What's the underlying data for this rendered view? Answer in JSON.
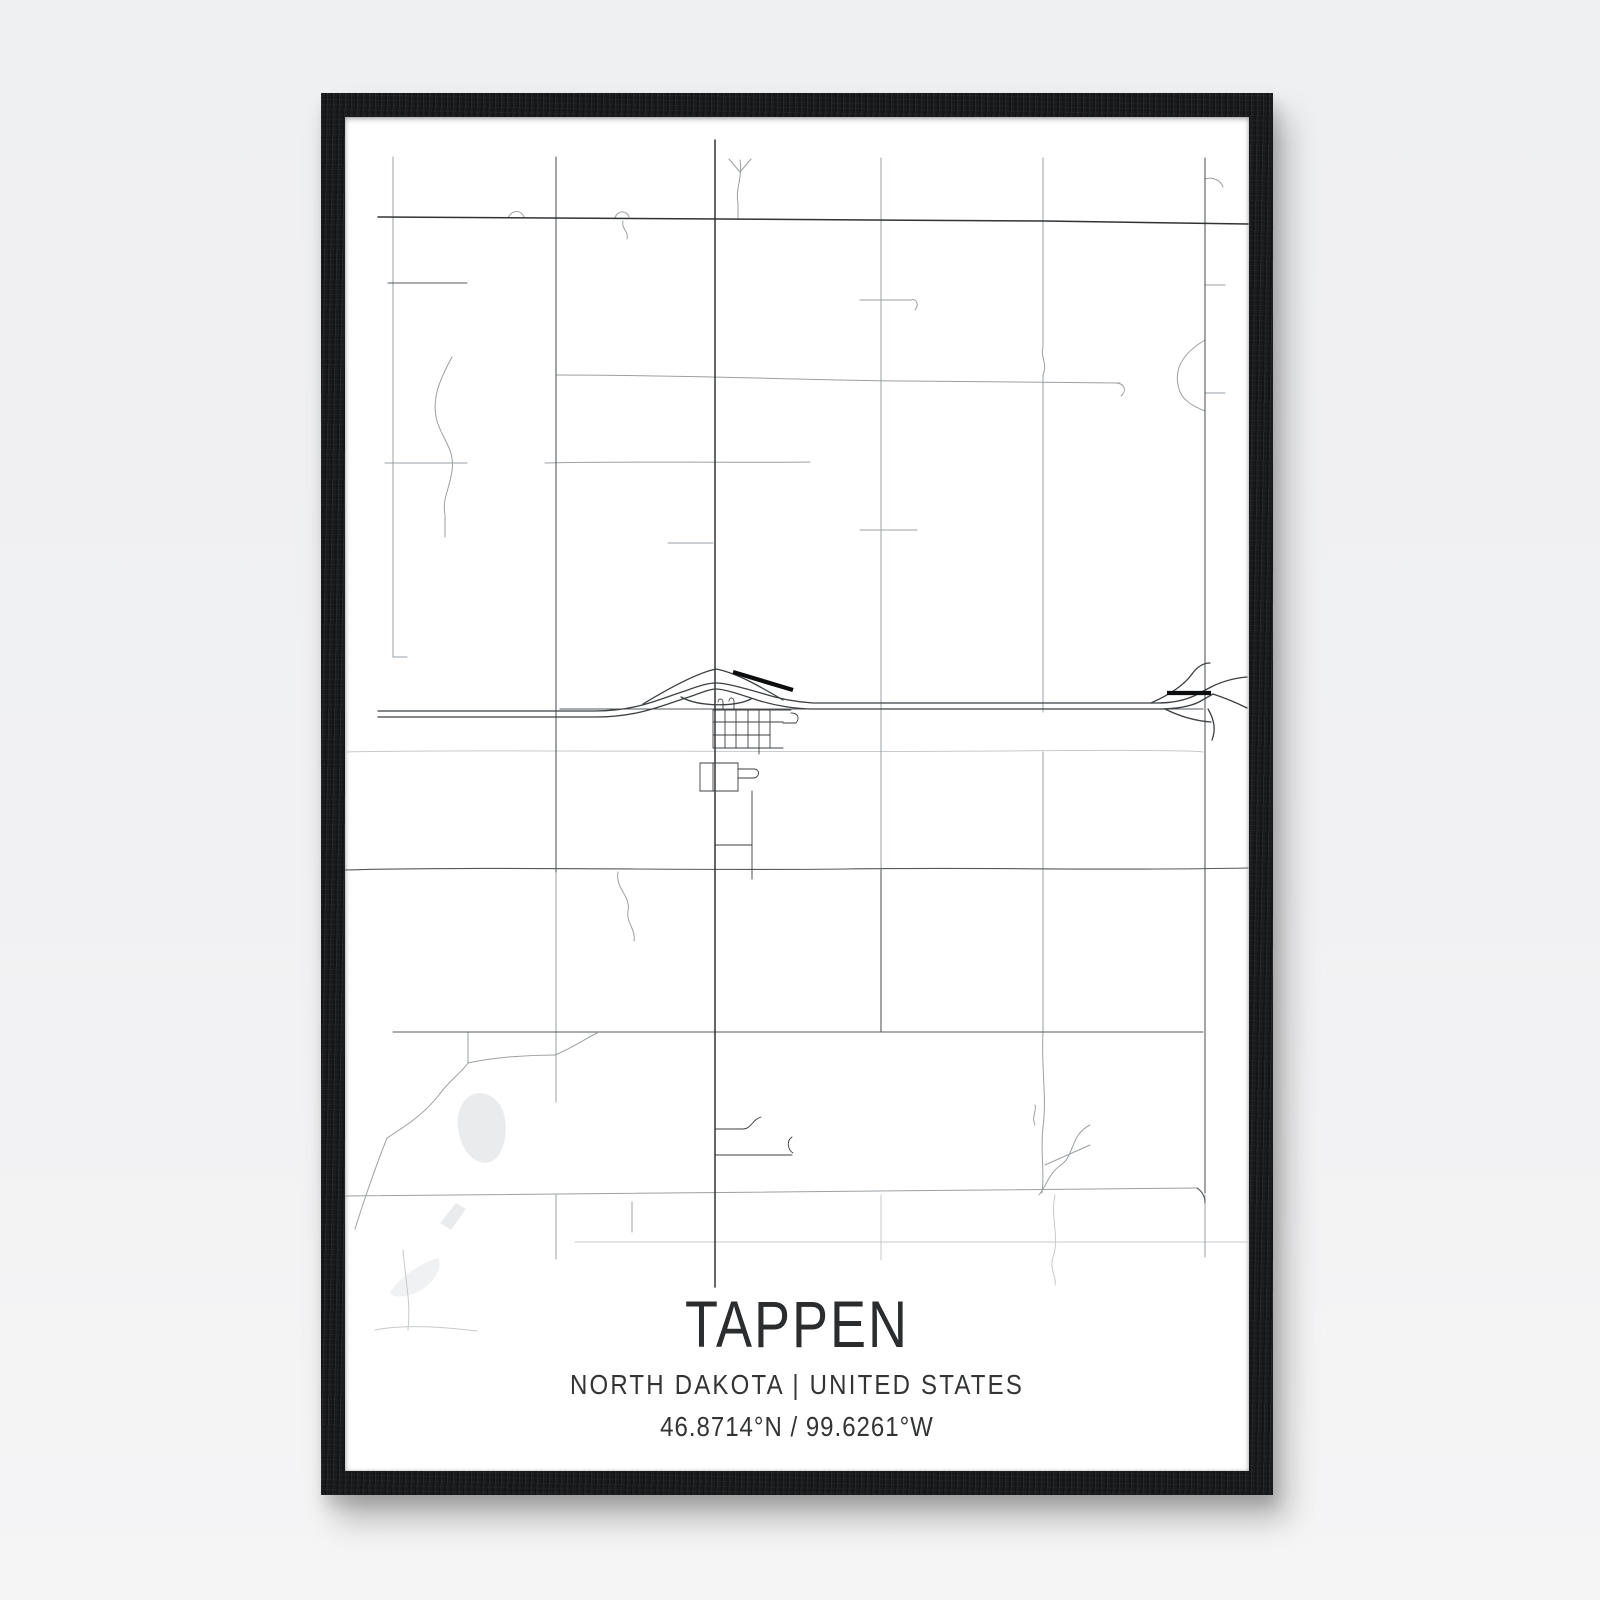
{
  "page": {
    "background_color": "#f1f1f3"
  },
  "frame": {
    "color": "#191a1c",
    "material": "black-wood"
  },
  "poster": {
    "background_color": "#ffffff",
    "title": "TAPPEN",
    "subtitle": "NORTH DAKOTA | UNITED STATES",
    "coordinates": "46.8714°N / 99.6261°W",
    "text_color": "#2a2c2e"
  },
  "map": {
    "type": "street-map",
    "location": {
      "city": "Tappen",
      "state": "North Dakota",
      "country": "United States",
      "latitude_label": "46.8714°N",
      "longitude_label": "99.6261°W"
    },
    "viewBox": "0 0 904 1354",
    "water": [
      {
        "name": "lake",
        "color": "#e9ebed",
        "paths": [
          "M118,986 C128,970 150,974 158,994 C164,1012 160,1034 149,1043 C137,1051 121,1041 115,1021 C111,1006 112,996 118,986 Z",
          "M95,1106 L111,1086 L121,1092 L106,1113 Z"
        ]
      },
      {
        "name": "pond-faint",
        "color": "#f0f1f2",
        "paths": [
          "M45,1176 C54,1160 76,1146 93,1141 C98,1150 90,1166 74,1174 C61,1181 49,1181 45,1176 Z"
        ]
      }
    ],
    "layers": [
      {
        "name": "faint",
        "color": "#c6cacd",
        "width": 1,
        "paths": [
          "M0,635 C150,632 400,636 650,634 S850,636 858,635",
          "M230,1125 H903",
          "M30,1213 C60,1207 100,1210 132,1214",
          "M58,1133 C60,1160 66,1185 63,1213",
          "M710,1078 C705,1100 715,1120 708,1140 C704,1152 712,1160 710,1168",
          "M536,1078 V1143"
        ]
      },
      {
        "name": "minor",
        "color": "#9ba0a4",
        "width": 1,
        "paths": [
          "M48,40 V540",
          "M48,540 H62",
          "M211,755 V985",
          "M211,1078 V1142",
          "M536,41 V753",
          "M698,41 V230 C695,240 703,246 698,258 V595",
          "M698,635 V915",
          "M698,915 C696,950 702,980 698,1010 C695,1035 700,1055 697,1076",
          "M860,1078 V1140",
          "M211,258 C350,258 450,263 560,264 L775,266",
          "M770,266 C780,266 782,274 776,279",
          "M40,346 H122",
          "M200,346 C280,344 380,346 465,345",
          "M515,413 H572",
          "M323,426 H368",
          "M860,62 C868,59 876,64 878,70",
          "M860,168 H880",
          "M860,276 H880",
          "M515,183 H566 C572,181 574,188 570,193",
          "M395,43 C398,60 390,72 393,86 V101",
          "M395,55 L384,42",
          "M395,55 L406,42",
          "M107,240 C95,262 86,282 92,304 C98,324 110,332 107,354 C104,374 97,382 100,398 V420",
          "M273,755 C270,772 286,778 283,794 C281,806 291,812 289,824",
          "M860,223 C838,236 828,252 834,272 C837,284 850,290 860,294",
          "M745,1008 C725,1018 730,1038 716,1048 C704,1056 702,1068 694,1078",
          "M700,1048 L745,1028",
          "M690,1008 C686,1000 692,994 690,988",
          "M42,1021 C62,1008 78,998 94,978 C102,966 116,956 123,946",
          "M10,1112 C18,1086 32,1046 42,1021",
          "M123,915 V946",
          "M123,946 C150,940 185,938 210,938",
          "M210,938 C225,932 240,922 252,916",
          "M287,1085 V1115",
          "M0,1079 L852,1071",
          "M163,101 C166,93 176,92 179,100",
          "M270,101 C272,93 282,93 284,100",
          "M278,104 C276,112 284,114 282,122"
        ]
      },
      {
        "name": "medium",
        "color": "#55595d",
        "width": 1.1,
        "paths": [
          "M43,166 H122",
          "M211,40 V755",
          "M536,753 V915",
          "M215,592 H858",
          "M0,753 C150,749 350,754 500,752 S750,754 903,751",
          "M48,915 H858",
          "M860,41 V1076",
          "M852,1071 C858,1075 860,1080 860,1086"
        ]
      },
      {
        "name": "major",
        "color": "#303336",
        "width": 1.5,
        "paths": [
          "M33,100 L700,104 L903,107",
          "M370,23 V1170"
        ]
      },
      {
        "name": "highway",
        "color": "#3c4043",
        "width": 1.3,
        "paths": [
          "M33,594 H250 C292,594 314,582 340,574 C356,568 364,566 371,566 C381,566 398,571 416,576 C434,582 452,585 468,586 H812 C830,586 843,582 851,578 L866,570",
          "M33,600 H250 C294,600 318,588 344,580 C358,575 365,572 371,572 C379,572 394,577 412,583 C431,589 452,592 468,592 H812 C832,592 846,589 854,585 L868,577",
          "M866,570 C878,564 890,561 902,560",
          "M868,577 C880,581 892,586 902,591",
          "M298,587 C326,570 352,556 371,552 C392,556 416,570 438,583",
          "M336,580 C354,590 390,590 406,582",
          "M806,586 C826,577 840,567 847,557 C852,550 858,546 865,546",
          "M863,592 C869,602 871,613 867,623",
          "M820,592 C836,600 852,604 866,605"
        ]
      },
      {
        "name": "town",
        "color": "#3b3e41",
        "width": 0.9,
        "paths": [
          "M368,593 V631",
          "M380,593 V631",
          "M391,593 V631",
          "M403,593 V631",
          "M414,593 V637",
          "M425,593 V631",
          "M368,593 H446",
          "M368,605 H438",
          "M368,618 H425",
          "M368,631 H438",
          "M373,585 C373,581 378,581 378,585 V593",
          "M384,584 C384,580 389,580 389,584 V593",
          "M446,596 C453,596 455,601 451,606 H438",
          "M355,646 H393",
          "M355,646 V674",
          "M355,674 H393",
          "M393,646 V674",
          "M368,646 V674",
          "M393,652 H409 C415,652 415,660 409,661 H393",
          "M407,674 V753",
          "M370,728 H407",
          "M407,753 V762",
          "M370,1012 H398 C406,1012 408,1002 416,1000",
          "M370,1038 H447",
          "M447,1020 C441,1024 443,1033 448,1036"
        ]
      },
      {
        "name": "railroad",
        "color": "#0c0d0e",
        "width": 4.3,
        "linecap": "butt",
        "paths": [
          "M388,555 L448,573",
          "M822,576 H866"
        ]
      }
    ]
  }
}
